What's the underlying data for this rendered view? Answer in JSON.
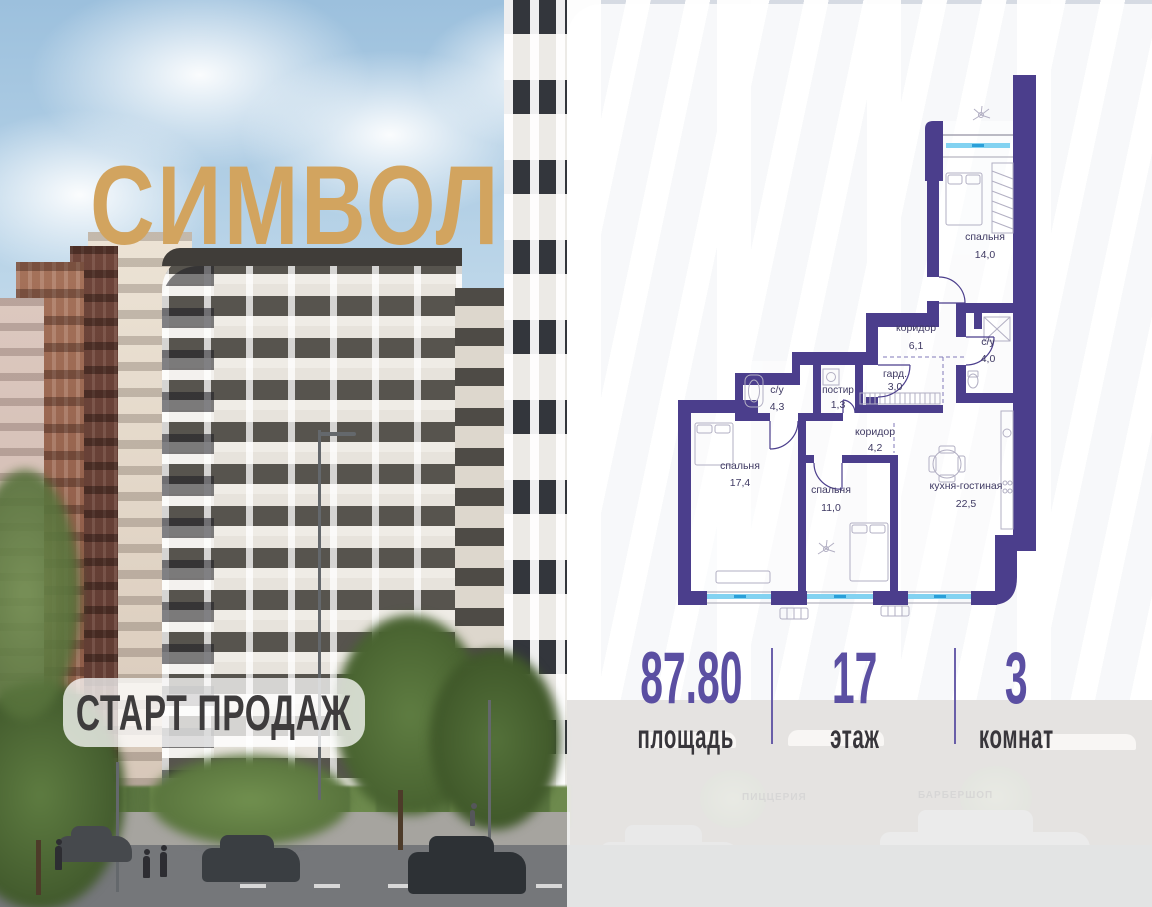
{
  "logo": {
    "text": "СИМВОЛ"
  },
  "badge": {
    "label": "СТАРТ ПРОДАЖ"
  },
  "floor_plan": {
    "rooms": [
      {
        "name": "спальня",
        "area": "14,0"
      },
      {
        "name": "коридор",
        "area": "6,1"
      },
      {
        "name": "с/у",
        "area": "4,0"
      },
      {
        "name": "гард.",
        "area": "3,0"
      },
      {
        "name": "постир",
        "area": "1,3"
      },
      {
        "name": "с/у",
        "area": "4,3"
      },
      {
        "name": "коридор",
        "area": "4,2"
      },
      {
        "name": "спальня",
        "area": "17,4"
      },
      {
        "name": "спальня",
        "area": "11,0"
      },
      {
        "name": "кухня-гостиная",
        "area": "22,5"
      }
    ]
  },
  "stats": [
    {
      "value": "87.80",
      "label": "площадь"
    },
    {
      "value": "17",
      "label": "этаж"
    },
    {
      "value": "3",
      "label": "комнат"
    }
  ],
  "storefront_signs": [
    "ПИЦЦЕРИЯ",
    "БАРБЕРШОП"
  ],
  "colors": {
    "accent_purple": "#5b4fa2",
    "wall_purple": "#4b3e8c",
    "logo_gold": "#d2a45f",
    "window_blue": "#82d2f1"
  }
}
